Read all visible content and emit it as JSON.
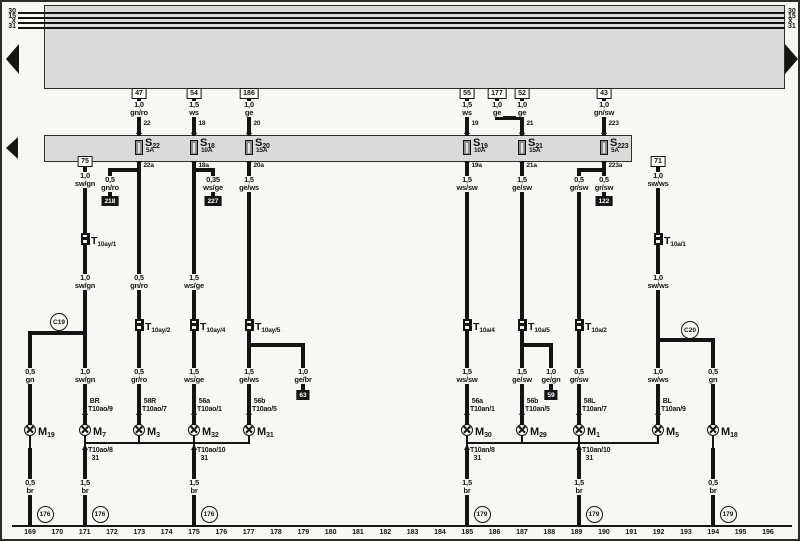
{
  "diagram": {
    "page": {
      "width": 800,
      "height": 541,
      "bg": "#f7f7f4",
      "band_fill": "#dadada",
      "line_color": "#141414"
    },
    "bus": {
      "labels": [
        "30",
        "15",
        "X",
        "31"
      ],
      "ys": [
        10,
        15,
        20,
        25
      ],
      "x1": 16,
      "x2": 783,
      "label_left_x": 1,
      "label_right_x": 786
    },
    "bands": [
      {
        "x": 42,
        "y": 3,
        "w": 741,
        "h": 84
      },
      {
        "x": 42,
        "y": 133,
        "w": 588,
        "h": 27
      }
    ],
    "continuation_arrows": [
      {
        "dir": "left",
        "x": 4,
        "cy": 57,
        "half_h": 15,
        "w": 13
      },
      {
        "dir": "left",
        "x": 4,
        "cy": 146,
        "half_h": 11,
        "w": 12
      },
      {
        "dir": "right",
        "x": 783,
        "cy": 57,
        "half_h": 15,
        "w": 13
      }
    ],
    "terminals": [
      {
        "label": "47",
        "x": 137,
        "y": 86
      },
      {
        "label": "54",
        "x": 192,
        "y": 86
      },
      {
        "label": "186",
        "x": 247,
        "y": 86
      },
      {
        "label": "55",
        "x": 465,
        "y": 86
      },
      {
        "label": "177",
        "x": 495,
        "y": 86
      },
      {
        "label": "52",
        "x": 520,
        "y": 86
      },
      {
        "label": "43",
        "x": 602,
        "y": 86
      },
      {
        "label": "75",
        "x": 83,
        "y": 154
      },
      {
        "label": "71",
        "x": 656,
        "y": 154
      }
    ],
    "fuses": [
      {
        "prefix": "S",
        "sub": "22",
        "amps": "5A",
        "x": 137
      },
      {
        "prefix": "S",
        "sub": "18",
        "amps": "10A",
        "x": 192
      },
      {
        "prefix": "S",
        "sub": "20",
        "amps": "15A",
        "x": 247
      },
      {
        "prefix": "S",
        "sub": "19",
        "amps": "10A",
        "x": 465
      },
      {
        "prefix": "S",
        "sub": "21",
        "amps": "15A",
        "x": 520
      },
      {
        "prefix": "S",
        "sub": "223",
        "amps": "5A",
        "x": 602
      }
    ],
    "fuse_pins_top": [
      {
        "label": "22",
        "x": 137
      },
      {
        "label": "18",
        "x": 192
      },
      {
        "label": "20",
        "x": 247
      },
      {
        "label": "19",
        "x": 465
      },
      {
        "label": "21",
        "x": 520
      },
      {
        "label": "223",
        "x": 602
      }
    ],
    "fuse_pins_bottom": [
      {
        "label": "22a",
        "x": 137
      },
      {
        "label": "18a",
        "x": 192
      },
      {
        "label": "20a",
        "x": 247
      },
      {
        "label": "19a",
        "x": 465
      },
      {
        "label": "21a",
        "x": 520
      },
      {
        "label": "223a",
        "x": 602
      }
    ],
    "track_refs": [
      {
        "label": "218",
        "x": 108,
        "y": 194
      },
      {
        "label": "227",
        "x": 211,
        "y": 194
      },
      {
        "label": "122",
        "x": 602,
        "y": 194
      },
      {
        "label": "63",
        "x": 301,
        "y": 388
      },
      {
        "label": "59",
        "x": 549,
        "y": 388
      }
    ],
    "connectors": [
      {
        "prefix": "T",
        "sub": "10ay/1",
        "x": 83,
        "y": 237
      },
      {
        "prefix": "T",
        "sub": "10a/1",
        "x": 656,
        "y": 237
      },
      {
        "prefix": "T",
        "sub": "10ay/2",
        "x": 137,
        "y": 323
      },
      {
        "prefix": "T",
        "sub": "10ay/4",
        "x": 192,
        "y": 323
      },
      {
        "prefix": "T",
        "sub": "10ay/5",
        "x": 247,
        "y": 323
      },
      {
        "prefix": "T",
        "sub": "10a/4",
        "x": 465,
        "y": 323
      },
      {
        "prefix": "T",
        "sub": "10a/5",
        "x": 520,
        "y": 323
      },
      {
        "prefix": "T",
        "sub": "10a/2",
        "x": 577,
        "y": 323
      }
    ],
    "lamps": [
      {
        "prefix": "M",
        "sub": "19",
        "x": 28,
        "y": 428
      },
      {
        "prefix": "M",
        "sub": "7",
        "x": 83,
        "y": 428
      },
      {
        "prefix": "M",
        "sub": "3",
        "x": 137,
        "y": 428
      },
      {
        "prefix": "M",
        "sub": "32",
        "x": 192,
        "y": 428
      },
      {
        "prefix": "M",
        "sub": "31",
        "x": 247,
        "y": 428
      },
      {
        "prefix": "M",
        "sub": "30",
        "x": 465,
        "y": 428
      },
      {
        "prefix": "M",
        "sub": "29",
        "x": 520,
        "y": 428
      },
      {
        "prefix": "M",
        "sub": "1",
        "x": 577,
        "y": 428
      },
      {
        "prefix": "M",
        "sub": "5",
        "x": 656,
        "y": 428
      },
      {
        "prefix": "M",
        "sub": "18",
        "x": 711,
        "y": 428
      }
    ],
    "pin_labels": [
      {
        "x": 83,
        "text": " BR\nT10ao/9"
      },
      {
        "x": 137,
        "text": " 58R\nT10ao/7"
      },
      {
        "x": 192,
        "text": " 56a\nT10ao/1"
      },
      {
        "x": 247,
        "text": " 56b\nT10ao/5"
      },
      {
        "x": 465,
        "text": " 56a\nT10an/1"
      },
      {
        "x": 520,
        "text": " 56b\nT10an/5"
      },
      {
        "x": 577,
        "text": " 58L\nT10an/7"
      },
      {
        "x": 656,
        "text": " BL\nT10an/9"
      }
    ],
    "below_labels": [
      {
        "x": 83,
        "text": "T10ao/8\n  31"
      },
      {
        "x": 192,
        "text": "T10ao/10\n  31"
      },
      {
        "x": 465,
        "text": "T10an/8\n  31"
      },
      {
        "x": 577,
        "text": "T10an/10\n  31"
      }
    ],
    "wire_labels": [
      {
        "x": 137,
        "y": 99,
        "text": "1,0\ngn/ro"
      },
      {
        "x": 192,
        "y": 99,
        "text": "1,5\nws"
      },
      {
        "x": 247,
        "y": 99,
        "text": "1,0\nge"
      },
      {
        "x": 465,
        "y": 99,
        "text": "1,5\nws"
      },
      {
        "x": 495,
        "y": 99,
        "text": "1,0\nge"
      },
      {
        "x": 520,
        "y": 99,
        "text": "1,0\nge"
      },
      {
        "x": 602,
        "y": 99,
        "text": "1,0\ngn/sw"
      },
      {
        "x": 83,
        "y": 170,
        "text": "1,0\nsw/gn"
      },
      {
        "x": 656,
        "y": 170,
        "text": "1,0\nsw/ws"
      },
      {
        "x": 108,
        "y": 174,
        "text": "0,5\ngn/ro"
      },
      {
        "x": 211,
        "y": 174,
        "text": "0,35\nws/ge"
      },
      {
        "x": 247,
        "y": 174,
        "text": "1,5\nge/ws"
      },
      {
        "x": 465,
        "y": 174,
        "text": "1,5\nws/sw"
      },
      {
        "x": 520,
        "y": 174,
        "text": "1,5\nge/sw"
      },
      {
        "x": 577,
        "y": 174,
        "text": "0,5\ngr/sw"
      },
      {
        "x": 602,
        "y": 174,
        "text": "0,5\ngr/sw"
      },
      {
        "x": 83,
        "y": 272,
        "text": "1,0\nsw/gn"
      },
      {
        "x": 137,
        "y": 272,
        "text": "0,5\ngn/ro"
      },
      {
        "x": 192,
        "y": 272,
        "text": "1,5\nws/ge"
      },
      {
        "x": 656,
        "y": 272,
        "text": "1,0\nsw/ws"
      },
      {
        "x": 28,
        "y": 366,
        "text": "0,5\ngn"
      },
      {
        "x": 83,
        "y": 366,
        "text": "1,0\nsw/gn"
      },
      {
        "x": 137,
        "y": 366,
        "text": "0,5\ngr/ro"
      },
      {
        "x": 192,
        "y": 366,
        "text": "1,5\nws/ge"
      },
      {
        "x": 247,
        "y": 366,
        "text": "1,5\nge/ws"
      },
      {
        "x": 301,
        "y": 366,
        "text": "1,0\nge/br"
      },
      {
        "x": 465,
        "y": 366,
        "text": "1,5\nws/sw"
      },
      {
        "x": 520,
        "y": 366,
        "text": "1,5\nge/sw"
      },
      {
        "x": 549,
        "y": 366,
        "text": "1,0\nge/gn"
      },
      {
        "x": 577,
        "y": 366,
        "text": "0,5\ngr/sw"
      },
      {
        "x": 656,
        "y": 366,
        "text": "1,0\nsw/ws"
      },
      {
        "x": 711,
        "y": 366,
        "text": "0,5\ngn"
      },
      {
        "x": 28,
        "y": 477,
        "text": "0,5\nbr"
      },
      {
        "x": 83,
        "y": 477,
        "text": "1,5\nbr"
      },
      {
        "x": 192,
        "y": 477,
        "text": "1,5\nbr"
      },
      {
        "x": 465,
        "y": 477,
        "text": "1,5\nbr"
      },
      {
        "x": 577,
        "y": 477,
        "text": "1,5\nbr"
      },
      {
        "x": 711,
        "y": 477,
        "text": "0,5\nbr"
      }
    ],
    "junctions": [
      {
        "label": "C19",
        "x": 57,
        "y": 320
      },
      {
        "label": "C20",
        "x": 688,
        "y": 328
      }
    ],
    "grounds": [
      {
        "label": "176",
        "x": 43,
        "y": 512
      },
      {
        "label": "176",
        "x": 98,
        "y": 512
      },
      {
        "label": "176",
        "x": 207,
        "y": 512
      },
      {
        "label": "179",
        "x": 480,
        "y": 512
      },
      {
        "label": "179",
        "x": 592,
        "y": 512
      },
      {
        "label": "179",
        "x": 726,
        "y": 512
      }
    ],
    "tracks": {
      "y": 527,
      "x_start": 28,
      "x_step": 27.33,
      "numbers": [
        "169",
        "170",
        "171",
        "172",
        "173",
        "174",
        "175",
        "176",
        "177",
        "178",
        "179",
        "180",
        "181",
        "182",
        "183",
        "184",
        "185",
        "186",
        "187",
        "188",
        "189",
        "190",
        "191",
        "192",
        "193",
        "194",
        "195",
        "196"
      ]
    },
    "wires_thick": [
      {
        "x": 137,
        "y1": 97,
        "y2": 134
      },
      {
        "x": 192,
        "y1": 97,
        "y2": 134
      },
      {
        "x": 247,
        "y1": 97,
        "y2": 134
      },
      {
        "x": 465,
        "y1": 97,
        "y2": 134
      },
      {
        "x": 520,
        "y1": 97,
        "y2": 134
      },
      {
        "x": 602,
        "y1": 97,
        "y2": 134
      },
      {
        "x": 495,
        "y1": 97,
        "y2": 118
      },
      {
        "y": 116,
        "x1": 493,
        "x2": 522
      },
      {
        "x": 137,
        "y1": 159,
        "y2": 318
      },
      {
        "x": 137,
        "y1": 329,
        "y2": 424
      },
      {
        "x": 192,
        "y1": 159,
        "y2": 318
      },
      {
        "x": 192,
        "y1": 329,
        "y2": 424
      },
      {
        "x": 247,
        "y1": 159,
        "y2": 318
      },
      {
        "x": 247,
        "y1": 329,
        "y2": 424
      },
      {
        "x": 465,
        "y1": 159,
        "y2": 318
      },
      {
        "x": 465,
        "y1": 329,
        "y2": 424
      },
      {
        "x": 520,
        "y1": 159,
        "y2": 318
      },
      {
        "x": 520,
        "y1": 329,
        "y2": 424
      },
      {
        "x": 602,
        "y1": 159,
        "y2": 195
      },
      {
        "y": 168,
        "x1": 106,
        "x2": 139
      },
      {
        "x": 108,
        "y1": 166,
        "y2": 195
      },
      {
        "y": 168,
        "x1": 190,
        "x2": 213
      },
      {
        "x": 211,
        "y1": 166,
        "y2": 195
      },
      {
        "y": 168,
        "x1": 575,
        "x2": 604
      },
      {
        "x": 577,
        "y1": 166,
        "y2": 318
      },
      {
        "x": 577,
        "y1": 329,
        "y2": 424
      },
      {
        "x": 83,
        "y1": 164,
        "y2": 232
      },
      {
        "x": 83,
        "y1": 243,
        "y2": 424
      },
      {
        "y": 331,
        "x1": 26,
        "x2": 85
      },
      {
        "x": 28,
        "y1": 329,
        "y2": 424
      },
      {
        "x": 656,
        "y1": 164,
        "y2": 232
      },
      {
        "x": 656,
        "y1": 243,
        "y2": 424
      },
      {
        "y": 338,
        "x1": 654,
        "x2": 713
      },
      {
        "x": 711,
        "y1": 336,
        "y2": 424
      },
      {
        "y": 343,
        "x1": 245,
        "x2": 303
      },
      {
        "x": 301,
        "y1": 341,
        "y2": 389
      },
      {
        "y": 343,
        "x1": 518,
        "x2": 551
      },
      {
        "x": 549,
        "y1": 341,
        "y2": 389
      },
      {
        "x": 28,
        "y1": 446,
        "y2": 524
      },
      {
        "x": 83,
        "y1": 446,
        "y2": 524
      },
      {
        "x": 192,
        "y1": 446,
        "y2": 524
      },
      {
        "x": 465,
        "y1": 446,
        "y2": 524
      },
      {
        "x": 577,
        "y1": 446,
        "y2": 524
      },
      {
        "x": 711,
        "y1": 446,
        "y2": 524
      }
    ],
    "wires_thin": [
      {
        "x": 28,
        "y1": 433,
        "y2": 448
      },
      {
        "x": 83,
        "y1": 433,
        "y2": 448
      },
      {
        "x": 137,
        "y1": 433,
        "y2": 442
      },
      {
        "x": 192,
        "y1": 433,
        "y2": 448
      },
      {
        "x": 247,
        "y1": 433,
        "y2": 442
      },
      {
        "x": 465,
        "y1": 433,
        "y2": 448
      },
      {
        "x": 520,
        "y1": 433,
        "y2": 442
      },
      {
        "x": 577,
        "y1": 433,
        "y2": 448
      },
      {
        "x": 656,
        "y1": 433,
        "y2": 442
      },
      {
        "x": 711,
        "y1": 433,
        "y2": 448
      },
      {
        "y": 441,
        "x1": 83,
        "x2": 248
      },
      {
        "y": 441,
        "x1": 465,
        "x2": 657
      },
      {
        "y": 524,
        "x1": 10,
        "x2": 790
      }
    ]
  }
}
